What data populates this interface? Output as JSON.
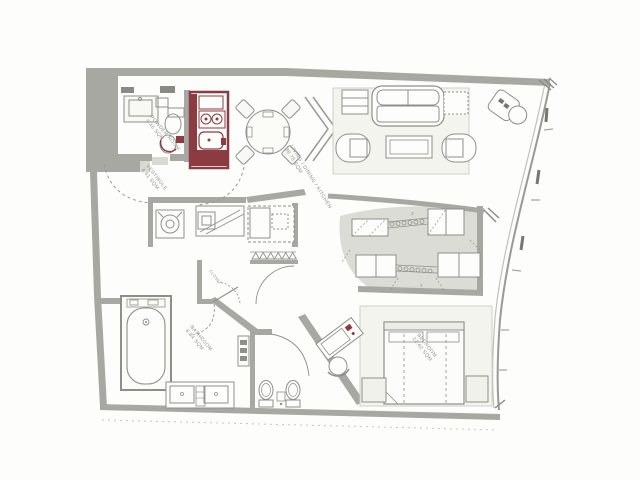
{
  "plan": {
    "rooms": [
      {
        "name": "POWDER ROOM",
        "area": "3.46 SQM"
      },
      {
        "name": "VESTIBULE",
        "area": "4.61 SQM"
      },
      {
        "name": "LIVING / DINING / KITCHEN",
        "area": "38.75 SQM"
      },
      {
        "name": "CLOSET",
        "area": ""
      },
      {
        "name": "BATHROOM",
        "area": "6.84 SQM"
      },
      {
        "name": "BEDROOM",
        "area": "22.42 SQM"
      }
    ],
    "tags": {
      "top": "3",
      "bottom": "2"
    },
    "colors": {
      "wall": "#a8a8a3",
      "accent": "#8c3c40",
      "floor_shade": "#dcdcd7",
      "line": "#8f8f8a",
      "label": "#8f8f88",
      "background": "#fdfdfc"
    }
  }
}
